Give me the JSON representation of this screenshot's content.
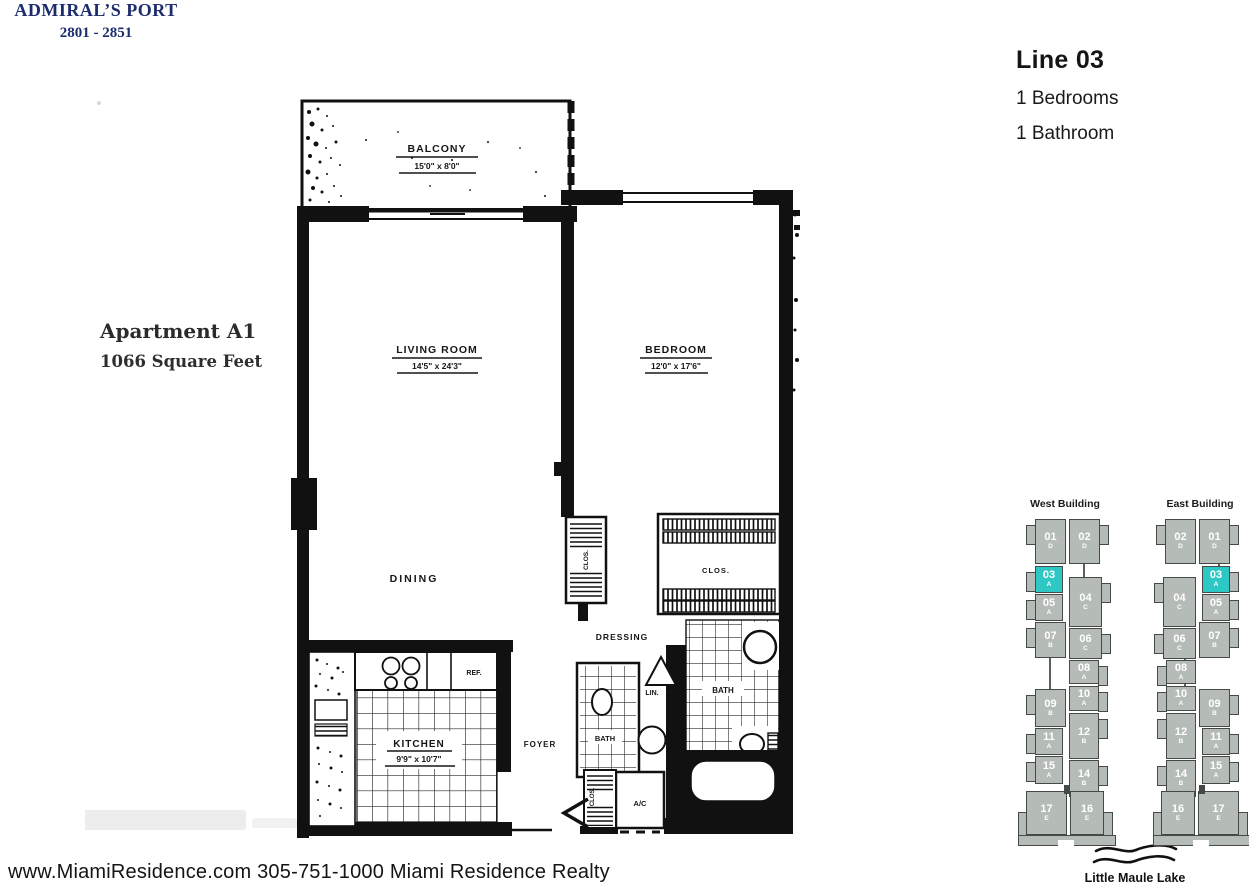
{
  "header": {
    "building_name": "ADMIRAL’S PORT",
    "address_range": "2801 - 2851"
  },
  "unit_info": {
    "line": "Line 03",
    "bedrooms": "1 Bedrooms",
    "bathrooms": "1 Bathroom"
  },
  "apartment": {
    "name": "Apartment A1",
    "area": "1066 Square Feet"
  },
  "floor_plan": {
    "balcony": {
      "label": "BALCONY",
      "dims": "15'0\" x 8'0\""
    },
    "living_room": {
      "label": "LIVING ROOM",
      "dims": "14'5\" x 24'3\""
    },
    "bedroom": {
      "label": "BEDROOM",
      "dims": "12'0\" x 17'6\""
    },
    "dining": {
      "label": "DINING"
    },
    "kitchen": {
      "label": "KITCHEN",
      "dims": "9'9\" x 10'7\""
    },
    "foyer": {
      "label": "FOYER"
    },
    "dressing": {
      "label": "DRESSING"
    },
    "bath_main": {
      "label": "BATH"
    },
    "bath_guest": {
      "label": "BATH"
    },
    "closet_hall": {
      "label": "CLOS."
    },
    "closet_bedroom": {
      "label": "CLOS."
    },
    "closet_entry": {
      "label": "CLOS."
    },
    "linen": {
      "label": "LIN."
    },
    "ac": {
      "label": "A/C"
    },
    "ref": {
      "label": "REF."
    }
  },
  "buildings": {
    "west": {
      "title": "West Building",
      "left_column": [
        {
          "number": "01",
          "letter": "D",
          "highlighted": false
        },
        {
          "number": "03",
          "letter": "A",
          "highlighted": true
        },
        {
          "number": "05",
          "letter": "A",
          "highlighted": false
        },
        {
          "number": "07",
          "letter": "B",
          "highlighted": false
        },
        {
          "number": "09",
          "letter": "B",
          "highlighted": false
        },
        {
          "number": "11",
          "letter": "A",
          "highlighted": false
        },
        {
          "number": "15",
          "letter": "A",
          "highlighted": false
        },
        {
          "number": "17",
          "letter": "E",
          "highlighted": false
        }
      ],
      "right_column": [
        {
          "number": "02",
          "letter": "D",
          "highlighted": false
        },
        {
          "number": "04",
          "letter": "C",
          "highlighted": false
        },
        {
          "number": "06",
          "letter": "C",
          "highlighted": false
        },
        {
          "number": "08",
          "letter": "A",
          "highlighted": false
        },
        {
          "number": "10",
          "letter": "A",
          "highlighted": false
        },
        {
          "number": "12",
          "letter": "B",
          "highlighted": false
        },
        {
          "number": "14",
          "letter": "B",
          "highlighted": false
        },
        {
          "number": "16",
          "letter": "E",
          "highlighted": false
        }
      ]
    },
    "east": {
      "title": "East Building",
      "left_column": [
        {
          "number": "02",
          "letter": "D",
          "highlighted": false
        },
        {
          "number": "04",
          "letter": "C",
          "highlighted": false
        },
        {
          "number": "06",
          "letter": "C",
          "highlighted": false
        },
        {
          "number": "08",
          "letter": "A",
          "highlighted": false
        },
        {
          "number": "10",
          "letter": "A",
          "highlighted": false
        },
        {
          "number": "12",
          "letter": "B",
          "highlighted": false
        },
        {
          "number": "14",
          "letter": "B",
          "highlighted": false
        },
        {
          "number": "16",
          "letter": "E",
          "highlighted": false
        }
      ],
      "right_column": [
        {
          "number": "01",
          "letter": "D",
          "highlighted": false
        },
        {
          "number": "03",
          "letter": "A",
          "highlighted": true
        },
        {
          "number": "05",
          "letter": "A",
          "highlighted": false
        },
        {
          "number": "07",
          "letter": "B",
          "highlighted": false
        },
        {
          "number": "09",
          "letter": "B",
          "highlighted": false
        },
        {
          "number": "11",
          "letter": "A",
          "highlighted": false
        },
        {
          "number": "15",
          "letter": "A",
          "highlighted": false
        },
        {
          "number": "17",
          "letter": "E",
          "highlighted": false
        }
      ]
    }
  },
  "lake_label": "Little Maule Lake",
  "footer": "www.MiamiResidence.com 305-751-1000 Miami Residence Realty",
  "colors": {
    "highlight_teal": "#2ec8c4",
    "unit_gray": "#b5bbb7",
    "unit_border": "#454a46",
    "navy": "#1c2c6e"
  }
}
